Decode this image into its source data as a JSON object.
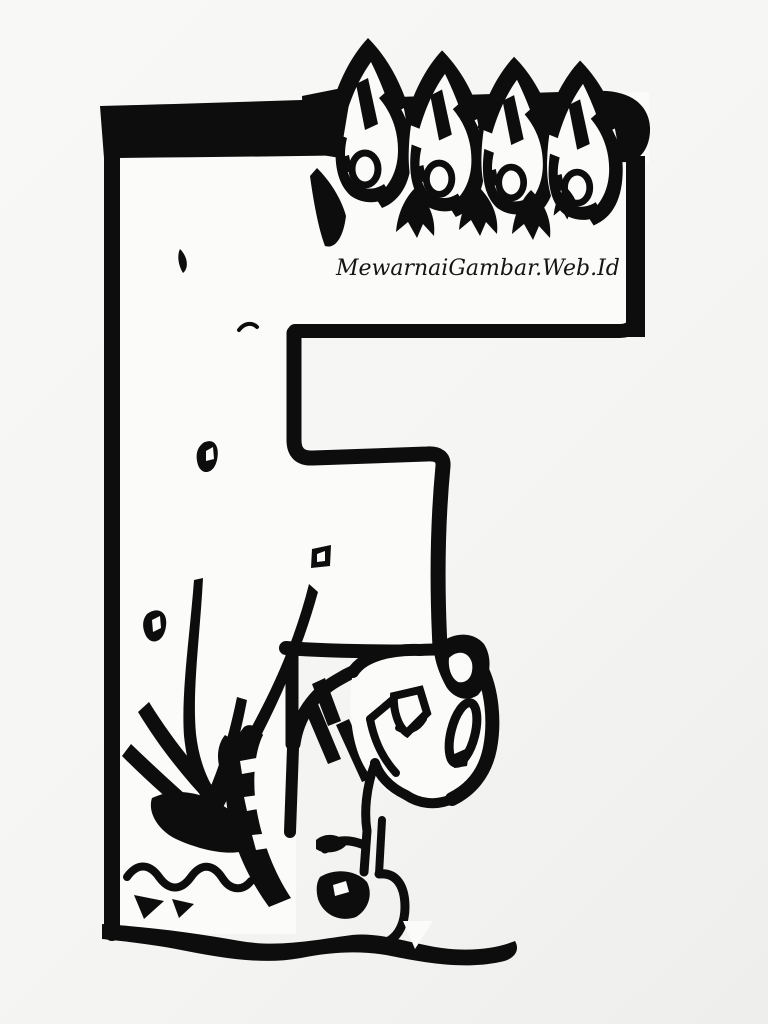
{
  "figure": {
    "letter": "F",
    "watermark": "MewarnaiGambar.Web.Id",
    "alt": "Black and white coloring page: capital letter F topped with flame shapes, with a striped kitten sitting beside a small campfire at its base"
  },
  "colors": {
    "background": "#f5f5f3",
    "paper": "#fbfbf9",
    "ink": "#0d0d0d"
  }
}
